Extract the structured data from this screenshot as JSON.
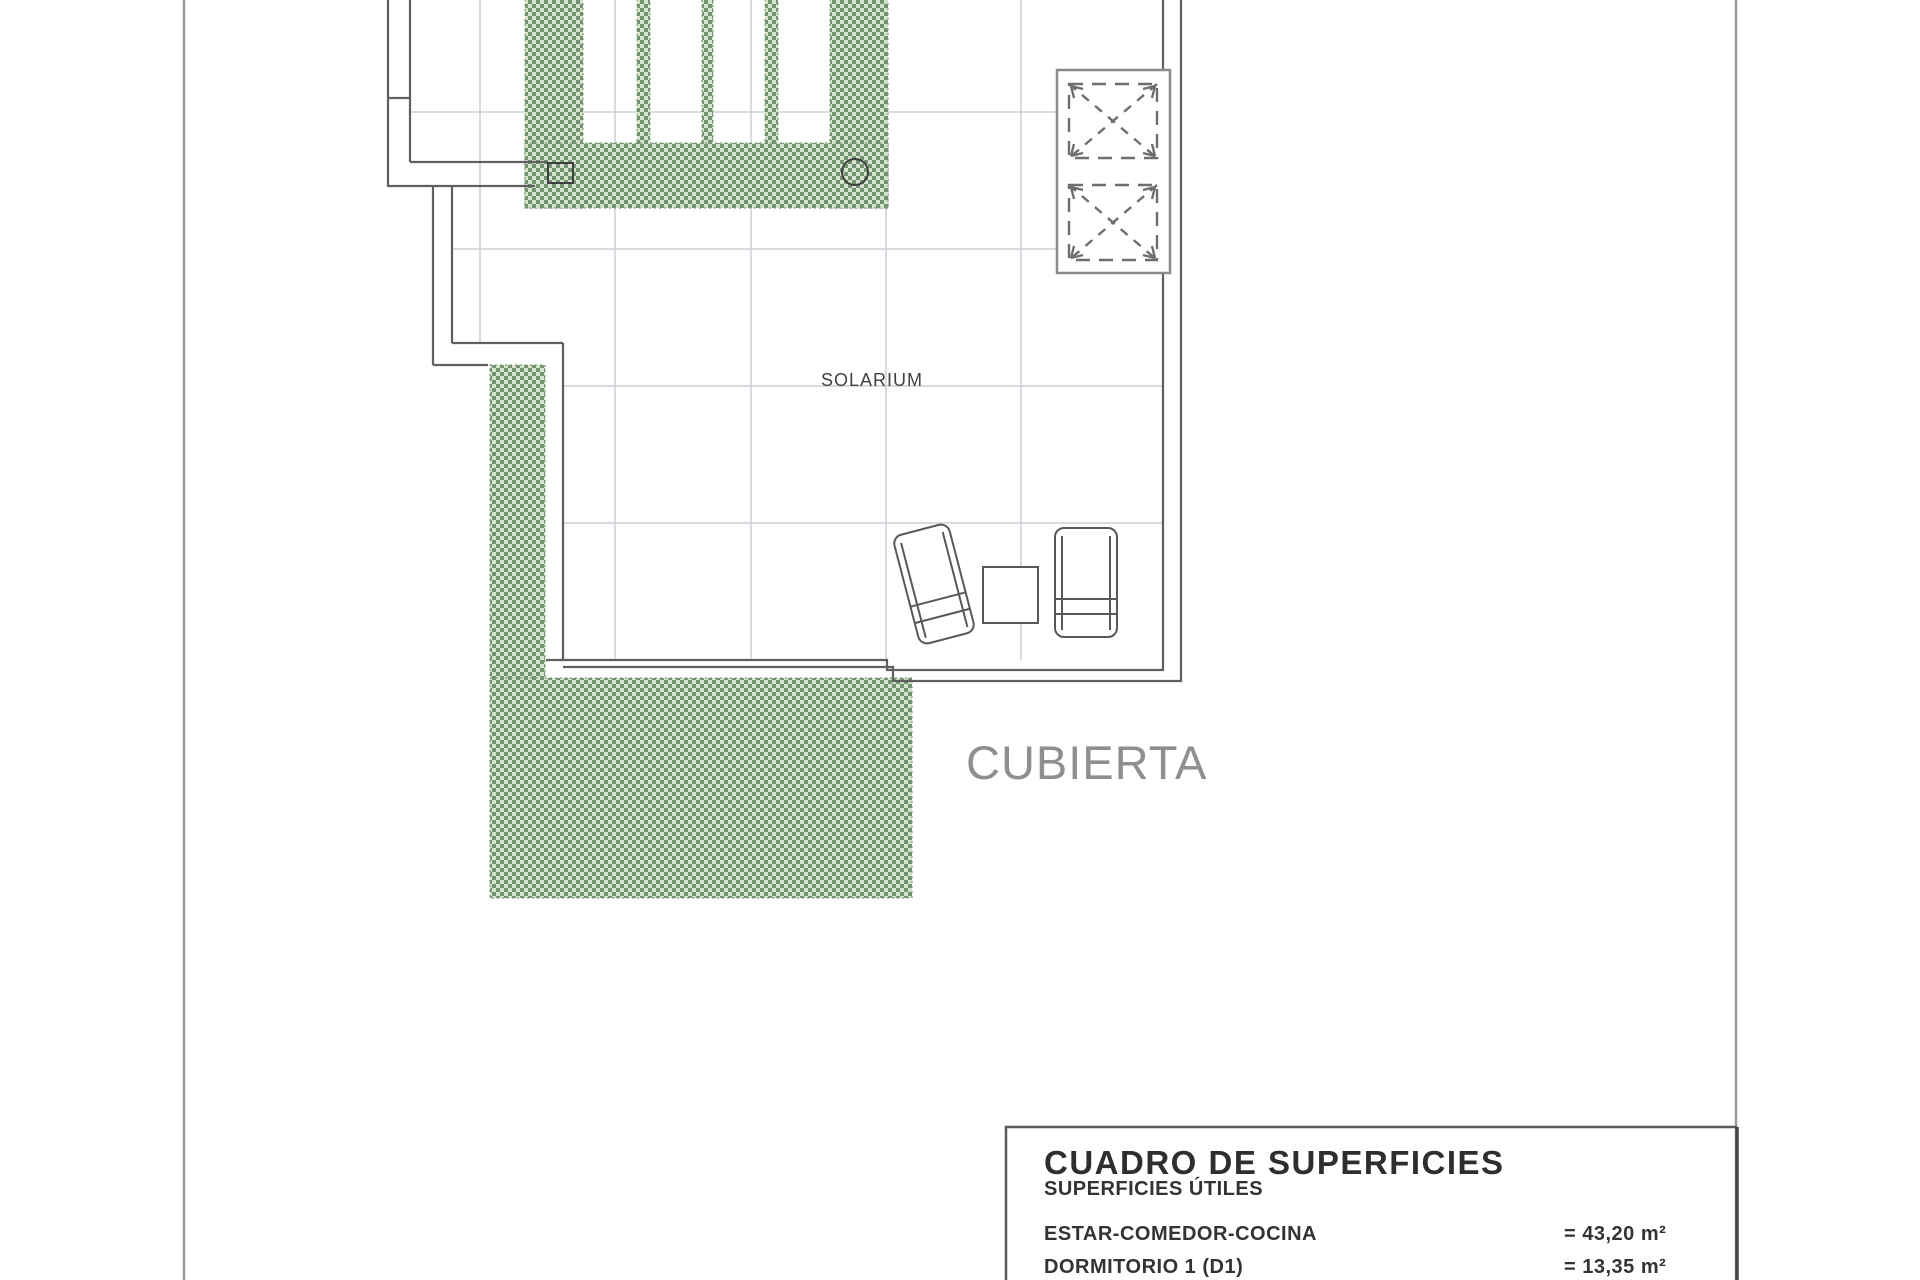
{
  "plan": {
    "labels": {
      "solarium": "SOLARIUM",
      "cubierta": "CUBIERTA"
    },
    "colors": {
      "hatch_dark_green": "#729370",
      "hatch_light_green": "#d6e3cf",
      "wall_line": "#5f5f5f",
      "tile_grid": "#ccd0d6",
      "page_frame": "#9b9b9b",
      "furniture_outline": "#585858",
      "skylight_outline": "#8a8a8a",
      "skylight_dash": "#6e6e6e"
    },
    "symbols": {
      "skylights": "two dashed squares with X diagonals",
      "furniture": "two sun loungers and side table",
      "drain_circle": "roof drain",
      "drain_box": "roof drain box"
    }
  },
  "surface_table": {
    "title": "CUADRO DE SUPERFICIES",
    "subtitle": "SUPERFICIES ÚTILES",
    "rows": [
      {
        "name": "ESTAR-COMEDOR-COCINA",
        "value": "= 43,20 m²"
      },
      {
        "name": "DORMITORIO 1 (D1)",
        "value": "= 13,35 m²"
      }
    ]
  }
}
